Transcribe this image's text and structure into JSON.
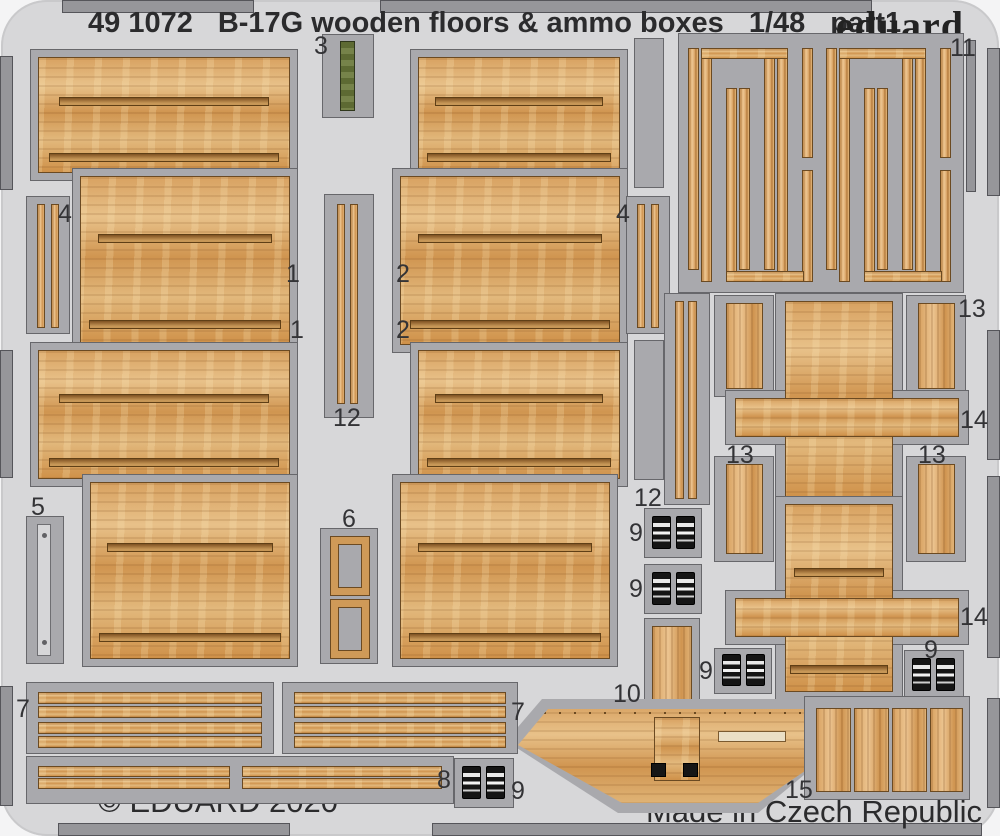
{
  "sheet": {
    "catalog_number": "49 1072",
    "title": "B-17G wooden floors & ammo boxes",
    "scale": "1/48",
    "part_designation": "part1",
    "brand": "eduard",
    "copyright": "© EDUARD 2020",
    "made_in": "Made in Czech Republic"
  },
  "part_numbers_visible": [
    "1",
    "2",
    "3",
    "4",
    "5",
    "6",
    "7",
    "8",
    "9",
    "10",
    "11",
    "12",
    "13",
    "14",
    "15"
  ],
  "part_labels": [
    {
      "text": "3",
      "x": 314,
      "y": 34
    },
    {
      "text": "11",
      "x": 950,
      "y": 36
    },
    {
      "text": "4",
      "x": 58,
      "y": 202
    },
    {
      "text": "4",
      "x": 616,
      "y": 202
    },
    {
      "text": "1",
      "x": 286,
      "y": 262
    },
    {
      "text": "2",
      "x": 396,
      "y": 262
    },
    {
      "text": "1",
      "x": 290,
      "y": 318
    },
    {
      "text": "2",
      "x": 396,
      "y": 318
    },
    {
      "text": "13",
      "x": 958,
      "y": 297
    },
    {
      "text": "12",
      "x": 333,
      "y": 406
    },
    {
      "text": "14",
      "x": 960,
      "y": 408
    },
    {
      "text": "13",
      "x": 726,
      "y": 443
    },
    {
      "text": "13",
      "x": 918,
      "y": 443
    },
    {
      "text": "5",
      "x": 31,
      "y": 495
    },
    {
      "text": "12",
      "x": 634,
      "y": 486
    },
    {
      "text": "6",
      "x": 342,
      "y": 507
    },
    {
      "text": "9",
      "x": 629,
      "y": 521
    },
    {
      "text": "9",
      "x": 629,
      "y": 577
    },
    {
      "text": "14",
      "x": 960,
      "y": 605
    },
    {
      "text": "9",
      "x": 924,
      "y": 638
    },
    {
      "text": "9",
      "x": 699,
      "y": 659
    },
    {
      "text": "10",
      "x": 613,
      "y": 682
    },
    {
      "text": "7",
      "x": 16,
      "y": 697
    },
    {
      "text": "7",
      "x": 511,
      "y": 700
    },
    {
      "text": "8",
      "x": 437,
      "y": 768
    },
    {
      "text": "9",
      "x": 511,
      "y": 779
    },
    {
      "text": "15",
      "x": 785,
      "y": 778
    }
  ],
  "colors": {
    "sheet_background": "#d7d7d9",
    "metal_frame": "#a9a9ad",
    "wood_base": "#d8a261",
    "ammo_box_black": "#151515",
    "ammo_belt_green": "#6e7b40",
    "text": "#2e2e30"
  }
}
